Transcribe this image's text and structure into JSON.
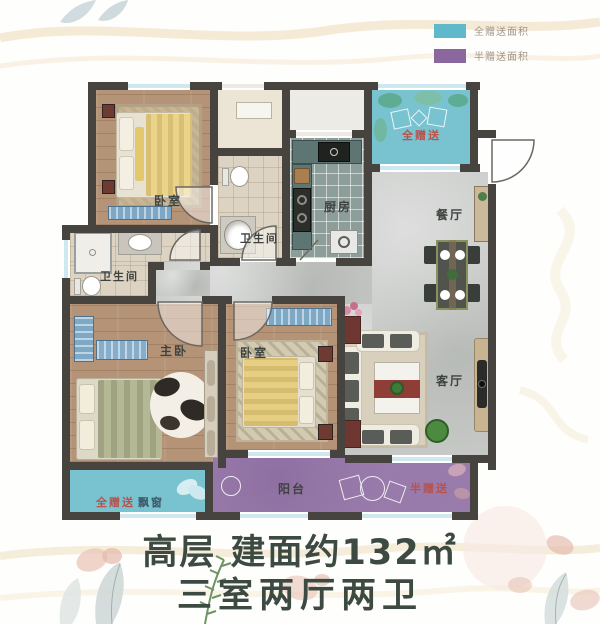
{
  "legend": {
    "items": [
      {
        "label": "全赠送面积",
        "color": "#5fb9ca"
      },
      {
        "label": "半赠送面积",
        "color": "#8a679c"
      }
    ]
  },
  "rooms": {
    "bedroom_top": "卧室",
    "bath_left": "卫生间",
    "bath_center": "卫生间",
    "kitchen": "厨房",
    "dining": "餐厅",
    "living": "客厅",
    "master": "主卧",
    "bedroom_mid": "卧室",
    "balcony": "阳台",
    "bay": "飘窗"
  },
  "gifts": {
    "top": "全赠送",
    "bay": "全赠送",
    "half": "半赠送"
  },
  "title": {
    "line1": "高层 建面约132㎡",
    "line2": "三室两厅两卫"
  },
  "colors": {
    "wall": "#474440",
    "full_gift_area": "#79c3d1",
    "half_gift_area": "#9a7dac",
    "gift_label_red": "#b8524a",
    "title_text": "#3d4a42"
  }
}
